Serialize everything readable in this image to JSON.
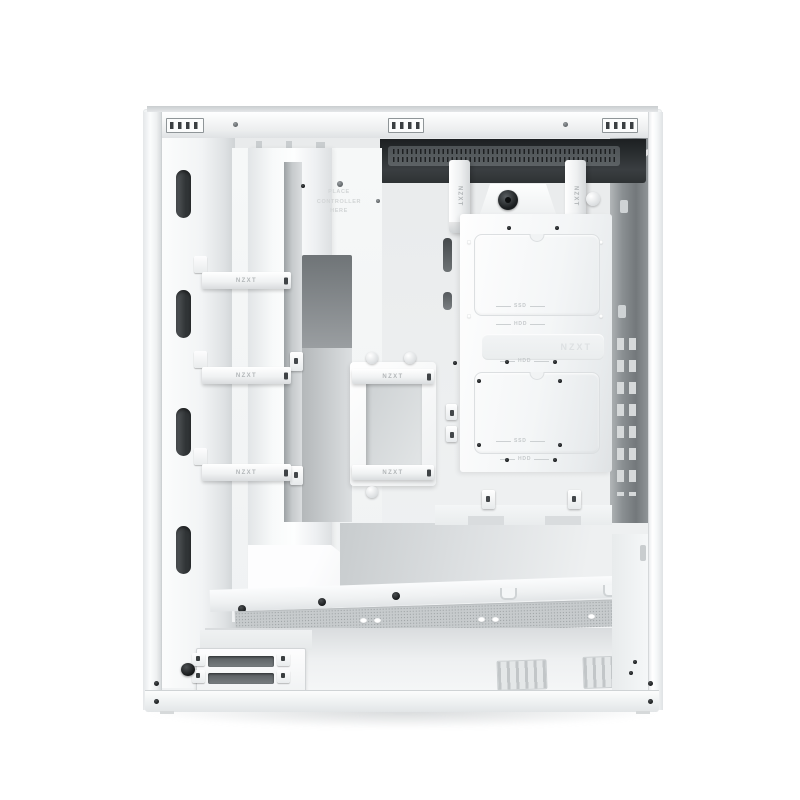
{
  "scene": {
    "subject": "White mid-tower PC case interior, side panel removed, front-left product view",
    "background": "#ffffff"
  },
  "branding": {
    "strap_label": "NZXT",
    "embossed_logo": "NZXT"
  },
  "tray_text": {
    "place_controller": "PLACE CONTROLLER HERE"
  },
  "drive_labels": {
    "ssd": "SSD",
    "hdd": "HDD"
  },
  "colors": {
    "case_white": "#f7f8f9",
    "panel_highlight": "#fdfdfe",
    "recess_gray": "#cfd3d5",
    "channel_gray": "#a8adb0",
    "vent_dark": "#2a2d2f",
    "vent_slot": "#595e61",
    "rear_wall": "#83888b",
    "mesh_gray": "#c9cdcf",
    "screw_black": "#202325",
    "stamp_gray": "#d3d6d8",
    "shadow_soft": "#ebedee"
  }
}
